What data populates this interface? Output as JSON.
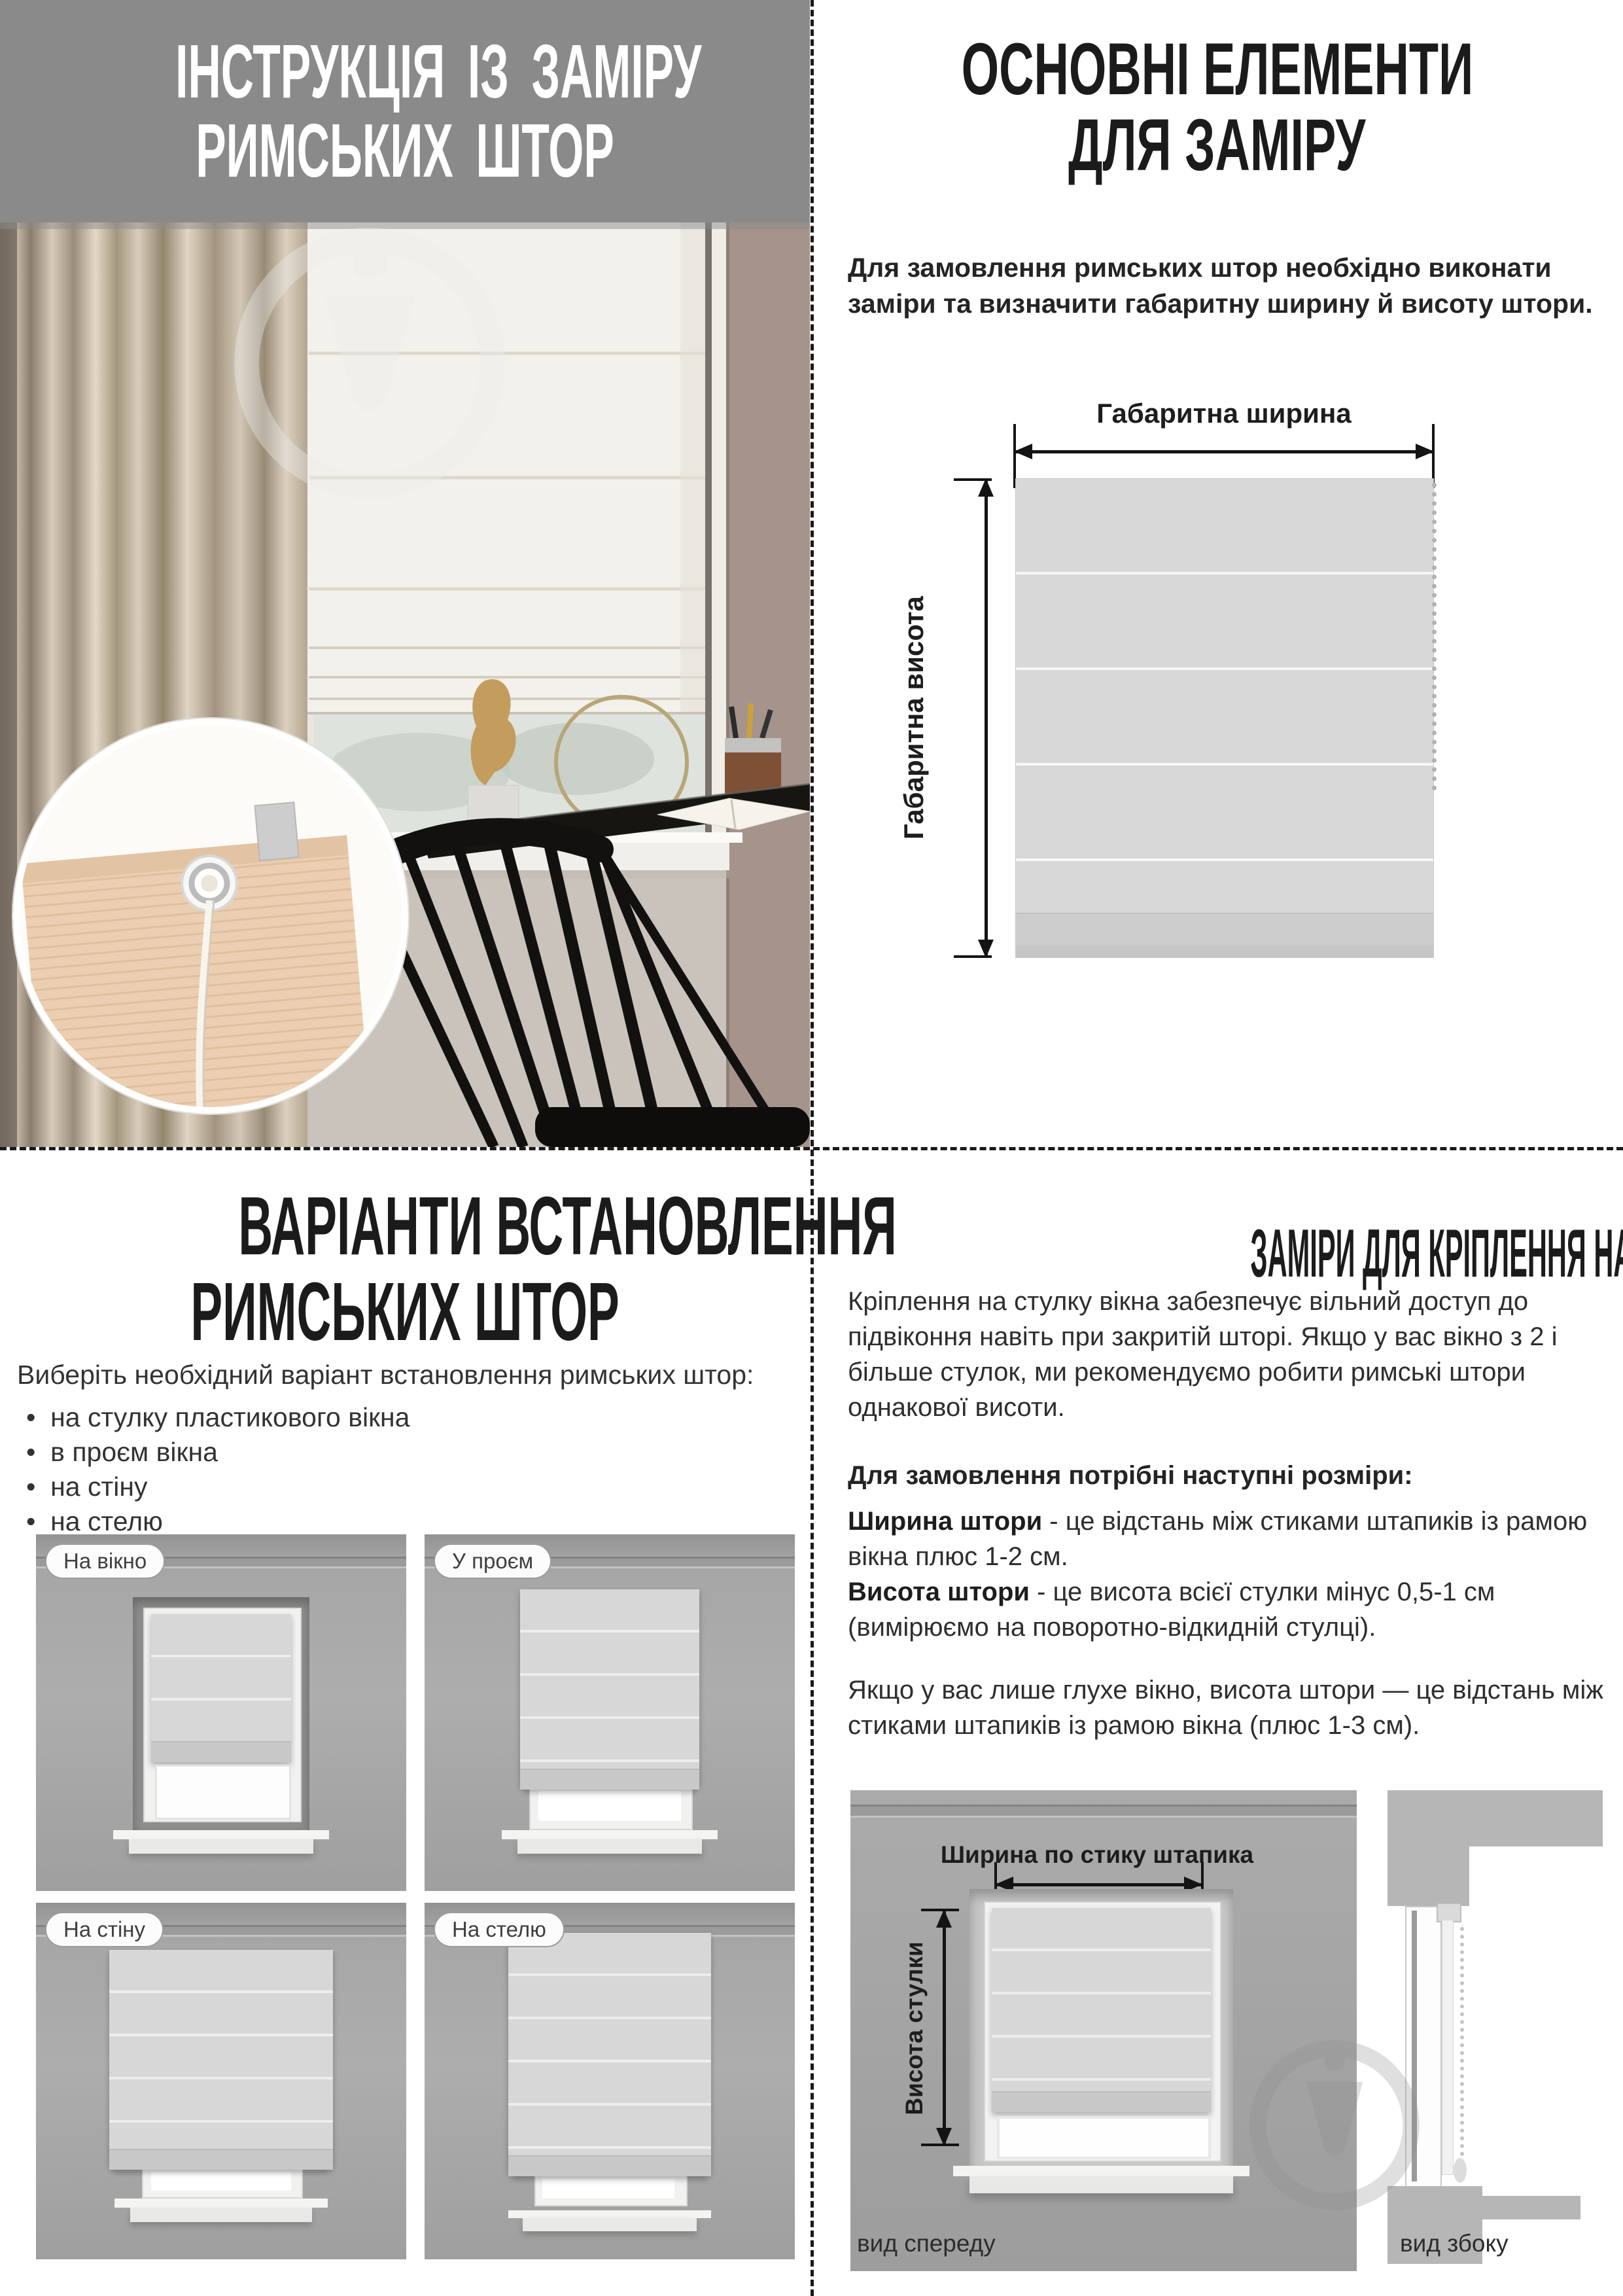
{
  "doc": {
    "top_left": {
      "title_line1": "ІНСТРУКЦІЯ ІЗ ЗАМІРУ",
      "title_line2": "РИМСЬКИХ ШТОР"
    },
    "top_right": {
      "title_line1": "ОСНОВНІ ЕЛЕМЕНТИ",
      "title_line2": "ДЛЯ ЗАМІРУ",
      "intro": "Для замовлення римських штор необхідно виконати заміри та визначити габаритну ширину й висоту штори.",
      "width_label": "Габаритна ширина",
      "height_label": "Габаритна висота"
    },
    "bottom_left": {
      "title_line1": "ВАРІАНТИ ВСТАНОВЛЕННЯ",
      "title_line2": "РИМСЬКИХ ШТОР",
      "intro": "Виберіть необхідний варіант встановлення римських штор:",
      "options": [
        "на стулку пластикового вікна",
        "в проєм вікна",
        "на стіну",
        "на стелю"
      ],
      "tiles": [
        {
          "label": "На вікно"
        },
        {
          "label": "У проєм"
        },
        {
          "label": "На стіну"
        },
        {
          "label": "На стелю"
        }
      ]
    },
    "bottom_right": {
      "title": "ЗАМІРИ ДЛЯ КРІПЛЕННЯ НА СТУЛКУ ВІКНА",
      "p1": "Кріплення на стулку вікна забезпечує вільний доступ до підвіконня навіть при закритій шторі. Якщо у вас вікно з 2 і більше стулок, ми рекомендуємо робити римські штори однакової висоти.",
      "p2": "Для замовлення потрібні наступні розміри:",
      "def1_term": "Ширина штори",
      "def1_text": " - це відстань між стиками штапиків із рамою вікна плюс 1-2 см.",
      "def2_term": "Висота штори",
      "def2_text": " - це висота всієї стулки мінус 0,5-1 см (вимірюємо на поворотно-відкидній стулці).",
      "p3": "Якщо у вас лише глухе вікно, висота штори — це відстань між стиками штапиків із рамою вікна (плюс 1-3 см).",
      "width_label": "Ширина по стику штапика",
      "height_label": "Висота стулки",
      "front_view": "вид спереду",
      "side_view": "вид збоку"
    }
  },
  "colors": {
    "header_gray": "#8a8a8a",
    "heading_text": "#1b1b1b",
    "body_text": "#2e2e2e",
    "tile_wall": "#a8a8a8",
    "diagram_blind": "#d7d7d7",
    "divider": "#1a1a1a"
  }
}
